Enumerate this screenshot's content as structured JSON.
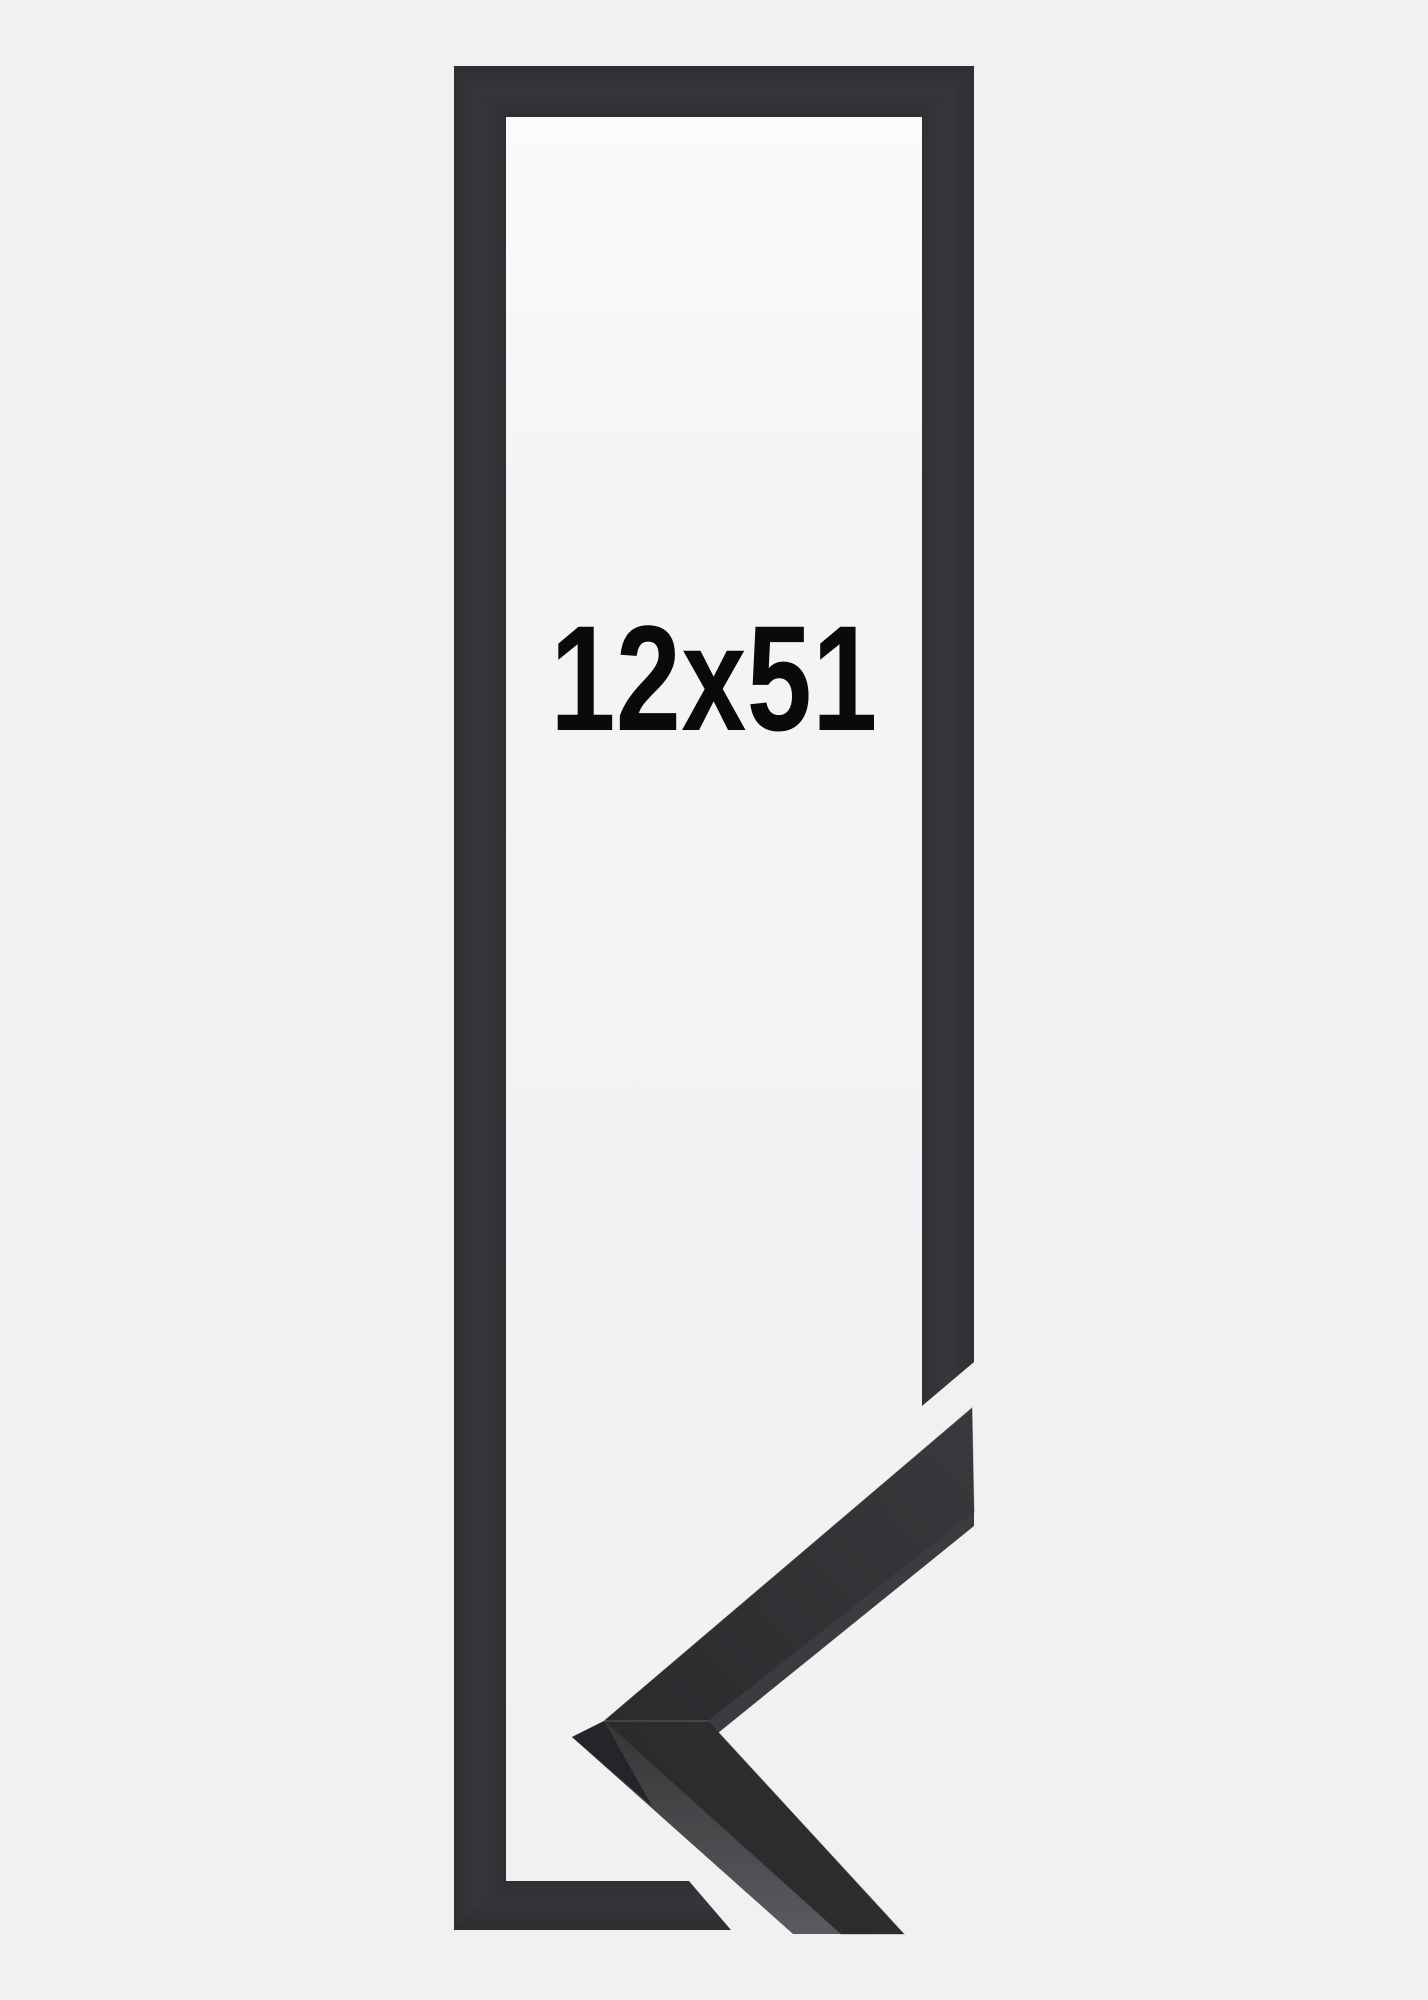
{
  "product_image": {
    "size_label": "12x51",
    "frame_color_hex": "#333437",
    "frame_face_dark_hex": "#2a2b2d",
    "frame_side_light_hex": "#55565a",
    "background_hex": "#f1f1f2",
    "opening_hex": "#f6f6f7",
    "label_color_hex": "#0a0a0b"
  }
}
